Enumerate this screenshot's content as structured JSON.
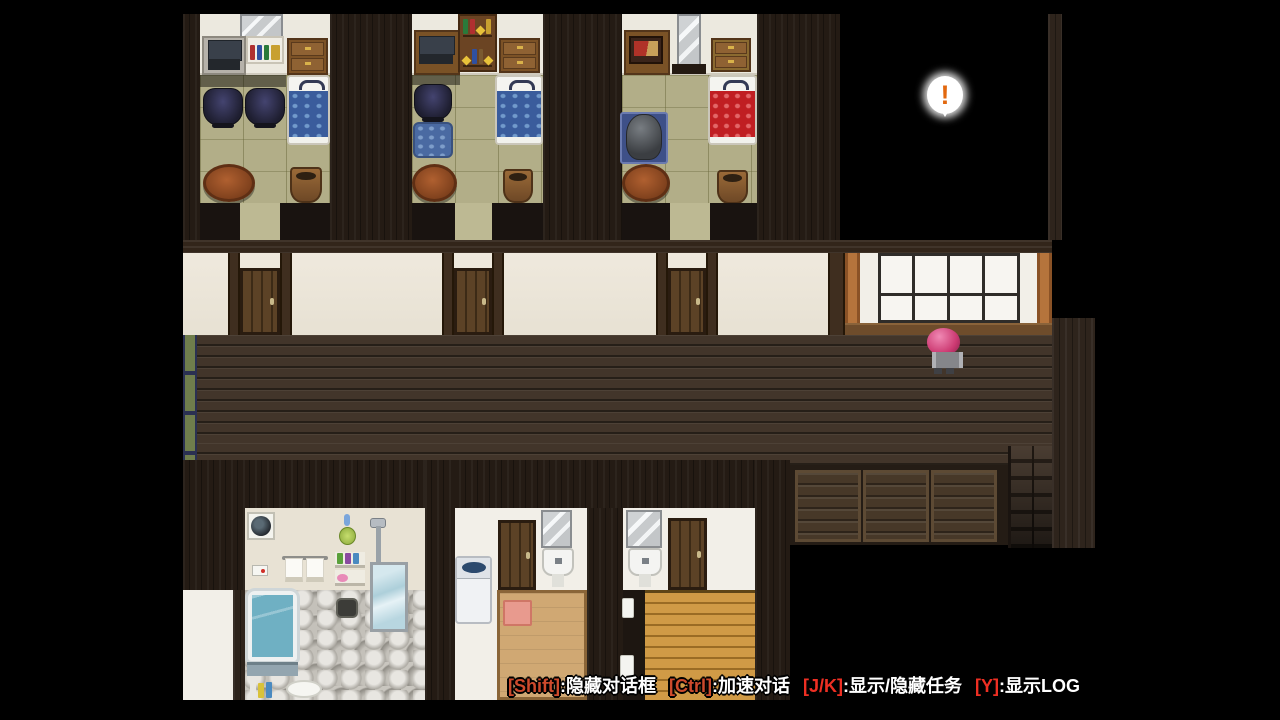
{
  "scene": {
    "balloon_symbol": "!"
  },
  "hint_bar": {
    "segments": [
      {
        "key": "[Shift]",
        "label": ":隐藏对话框"
      },
      {
        "key": "[Ctrl]",
        "label": ":加速对话"
      },
      {
        "key": "[J/K]",
        "label": ":显示/隐藏任务"
      },
      {
        "key": "[Y]",
        "label": ":显示LOG"
      }
    ]
  },
  "colors": {
    "key_warm": "#cd4a2c",
    "key_red": "#ee2f23",
    "hint_text": "#ffffff",
    "balloon_icon": "#e2680f",
    "hair_pink": "#cc3a72",
    "corridor_floor": "#42352a",
    "tatami": "#b2ae88",
    "hall_wall": "#ece6da",
    "door_wood": "#5c4226",
    "window_pillar": "#b5743c",
    "bed_blue": "#3a5c9c",
    "bed_red": "#c01e22",
    "tan_floor": "#d0a873",
    "plank_floor_orange": "#c8913f",
    "bath_water": "#6fb0c3"
  }
}
